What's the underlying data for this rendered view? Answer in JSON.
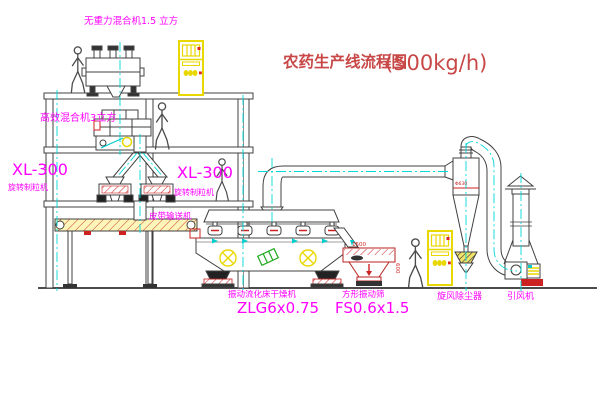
{
  "diagram": {
    "title": {
      "text": "农药生产线流程图",
      "capacity": "(500kg/h)"
    },
    "equipment": {
      "gravity_mixer": {
        "label": "无重力混合机1.5 立方"
      },
      "high_eff_mixer": {
        "label": "高效混合机3立方"
      },
      "granulator_left": {
        "model": "XL-300",
        "name": "旋转制粒机"
      },
      "granulator_right": {
        "model": "XL-300",
        "name": "旋转制粒机"
      },
      "belt_conveyor": {
        "label": "皮带输送机"
      },
      "fluid_bed_dryer": {
        "name": "振动流化床干燥机",
        "model": "ZLG6x0.75"
      },
      "square_sieve": {
        "name": "方形振动筛",
        "model": "FS0.6x1.5",
        "dim_length": "1500",
        "dim_width": "600"
      },
      "cyclone": {
        "label": "旋风除尘器",
        "dim_dia": "Φ630"
      },
      "fan": {
        "label": "引风机"
      }
    },
    "colors": {
      "label_magenta": "#ff00ff",
      "title_red": "#c84848",
      "dim_red": "#cc2222",
      "centerline_cyan": "#00d8d8",
      "cabinet_yellow": "#e8d800",
      "hatch_red": "#cc2222",
      "line_dark": "#404040",
      "base_red": "#cc2222",
      "motor_green": "#1faa1f"
    }
  }
}
